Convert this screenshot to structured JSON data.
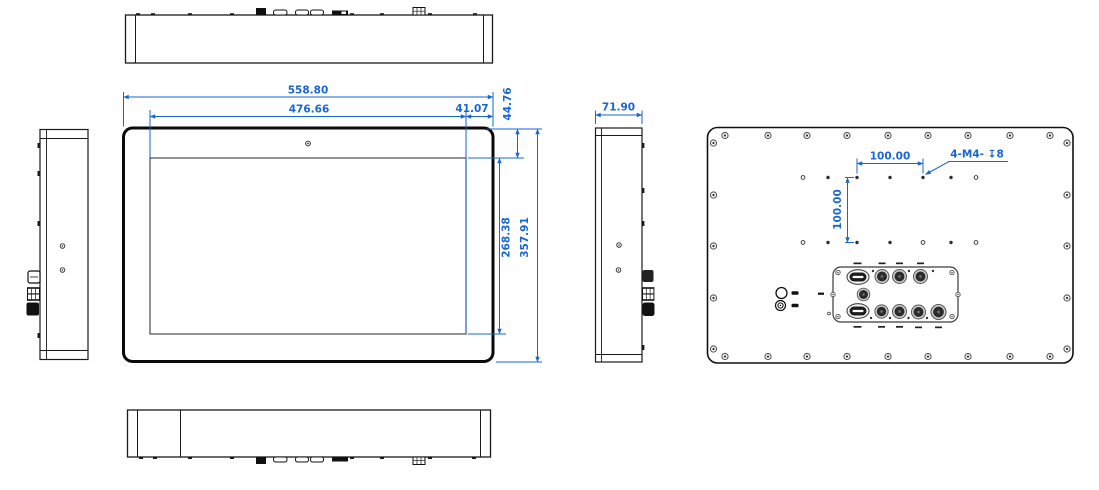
{
  "colors": {
    "dimension_blue": "#1866d4",
    "outline_black": "#1a1a1a"
  },
  "views": {
    "front": {
      "dims": {
        "overall_width": "558.80",
        "display_width": "476.66",
        "bezel_side": "41.07",
        "bezel_top": "44.76",
        "display_height": "268.38",
        "overall_height": "357.91"
      }
    },
    "right_side": {
      "dims": {
        "depth": "71.90"
      }
    },
    "back": {
      "dims": {
        "vesa_horizontal": "100.00",
        "vesa_vertical": "100.00",
        "mount_holes_note": "4-M4- ↧8"
      }
    }
  }
}
